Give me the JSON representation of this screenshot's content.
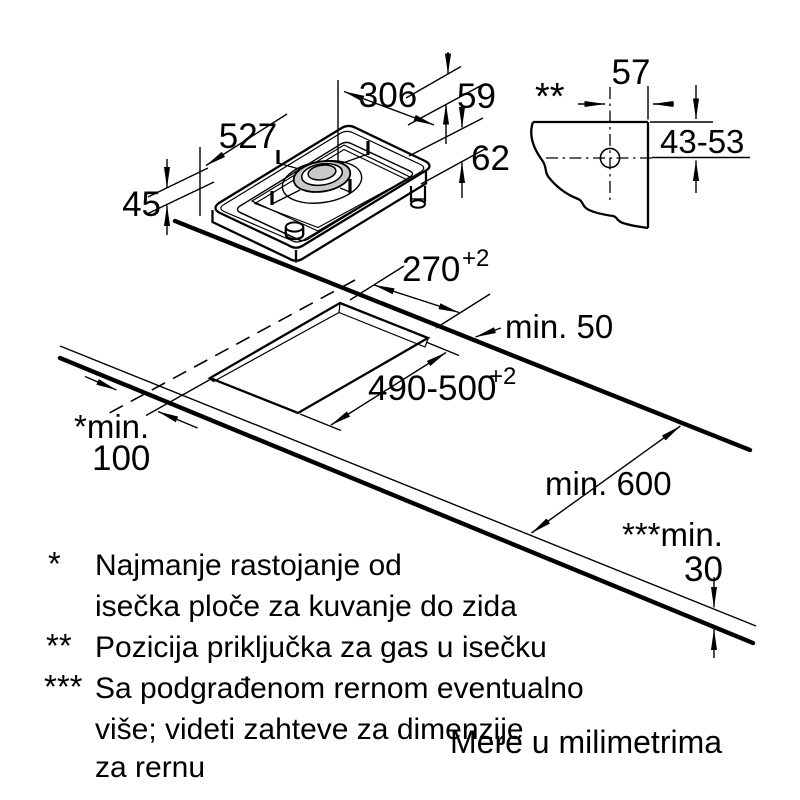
{
  "hob": {
    "dim_length": "527",
    "dim_width": "306",
    "dim_grate_height": "59",
    "dim_gas_depth": "62",
    "dim_height": "45"
  },
  "gas_detail": {
    "marker": "**",
    "dim_from_edge": "57",
    "dim_from_top": "43-53"
  },
  "worktop": {
    "cutout_width": "270",
    "cutout_width_tol": "+2",
    "cutout_depth": "490-500",
    "cutout_depth_tol": "+2",
    "rear_gap": "min. 50",
    "wall_gap_label": "*min.",
    "wall_gap_value": "100",
    "front_depth": "min. 600",
    "thickness_label": "***min.",
    "thickness_value": "30"
  },
  "footnotes": {
    "f1_marker": "*",
    "f1_line1": "Najmanje rastojanje od",
    "f1_line2": "isečka ploče za kuvanje do zida",
    "f2_marker": "**",
    "f2_line1": "Pozicija priključka za gas u isečku",
    "f3_marker": "***",
    "f3_line1": "Sa podgrađenom rernom eventualno",
    "f3_line2": "više; videti zahteve za dimenzije",
    "f3_line3": "za rernu"
  },
  "units_note": "Mere u milimetrima",
  "colors": {
    "line": "#000000",
    "burner_gray": "#c9c9c9",
    "background": "#ffffff"
  }
}
